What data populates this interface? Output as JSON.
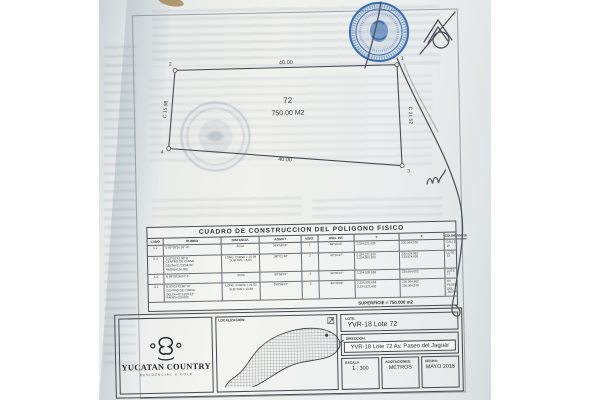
{
  "plot": {
    "lot_number": "72",
    "area": "750.00 M2",
    "top_edge": "40.00",
    "bottom_edge": "40.00",
    "left_edge": "C 15.98",
    "right_edge": "C 21.52",
    "vertex_1": "1",
    "vertex_2": "2",
    "vertex_3": "3",
    "vertex_4": "4"
  },
  "table": {
    "title": "CUADRO DE CONSTRUCCION DEL POLIGONO FISICO",
    "headers": [
      "LADO",
      "RUMBO",
      "DISTANCIA",
      "AZIMUT",
      "VERT.",
      "ANG. INT.",
      "Y",
      "X",
      "COLINDANCIA"
    ],
    "rows": [
      {
        "lado": "1-2",
        "rumbo": "S 89°58'16.04\" W",
        "distancia": "40.00",
        "azimut": "269°58'16\"",
        "vert": "1",
        "ang_int": "89°59'35\"",
        "y": "2,354,521.633",
        "x": "230,964.578",
        "colindancia": "CALLE 19"
      },
      {
        "lado": "2-4",
        "rumbo": "S 00°01'43.96\" E\nCENTRO DE CURVA\nDELTA=31°28'54.34\"\nRADIO=150.000",
        "distancia": "LONG. CURVA = 15.98\nSUB TAN = 8.03",
        "vert": "2",
        "azimut": "180°01'44\"",
        "ang_int": "90°19'47\"",
        "y": "2,354,521.509\n2,354,505.533",
        "x": "230,924.581\n230,924.605",
        "colindancia": "LOTE 73"
      },
      {
        "lado": "4-3",
        "rumbo": "N 89°58'16.04\" E",
        "distancia": "40.00",
        "azimut": "89°58'16\"",
        "vert": "4",
        "ang_int": "90°00'12\"",
        "y": "2,354,505.658",
        "x": "230,964.602",
        "colindancia": "LOTE 71"
      },
      {
        "lado": "3-1",
        "rumbo": "N 00°01'43.96\" W\nCENTRO DE CURVA\nDELTA=42°13'05.12\"\nRADIO=150.000",
        "distancia": "LONG. CURVA = 21.52\nSUB TAN = 10.86",
        "vert": "3",
        "azimut": "359°58'17\"",
        "ang_int": "89°40'26\"",
        "y": "2,354,505.658\n2,354,521.633",
        "x": "230,964.602\n230,964.578",
        "colindancia": "AV. PASEO DEL JAGUAR"
      }
    ],
    "superficie": "SUPERFICIE = 750.000 m2"
  },
  "title_block": {
    "brand_name": "YUCATAN COUNTRY",
    "brand_tagline": "RESIDENCIAL & GOLF",
    "localizacion_label": "LOCALIZACIÓN:",
    "lote_label": "LOTE:",
    "lote_value": "YVR-18 Lote 72",
    "direccion_label": "DIRECCIÓN:",
    "direccion_value": "YVR-18 Lote 72 Av. Paseo del Jaguar",
    "escala_label": "ESCALA",
    "escala_value": "1 : 300",
    "acotaciones_label": "ACOTACIONES:",
    "acotaciones_value": "METROS",
    "fecha_label": "FECHA:",
    "fecha_value": "MAYO 2018"
  },
  "colors": {
    "seal_blue": "#2a63a8",
    "ink": "#474e57",
    "paper": "#f1f1ee",
    "line": "#4b5054"
  },
  "icons": {
    "notary_seal": "circular-blue-notary-seal",
    "embossed_seal": "faint-round-official-stamp",
    "north_marker": "north-arrow-icon"
  }
}
